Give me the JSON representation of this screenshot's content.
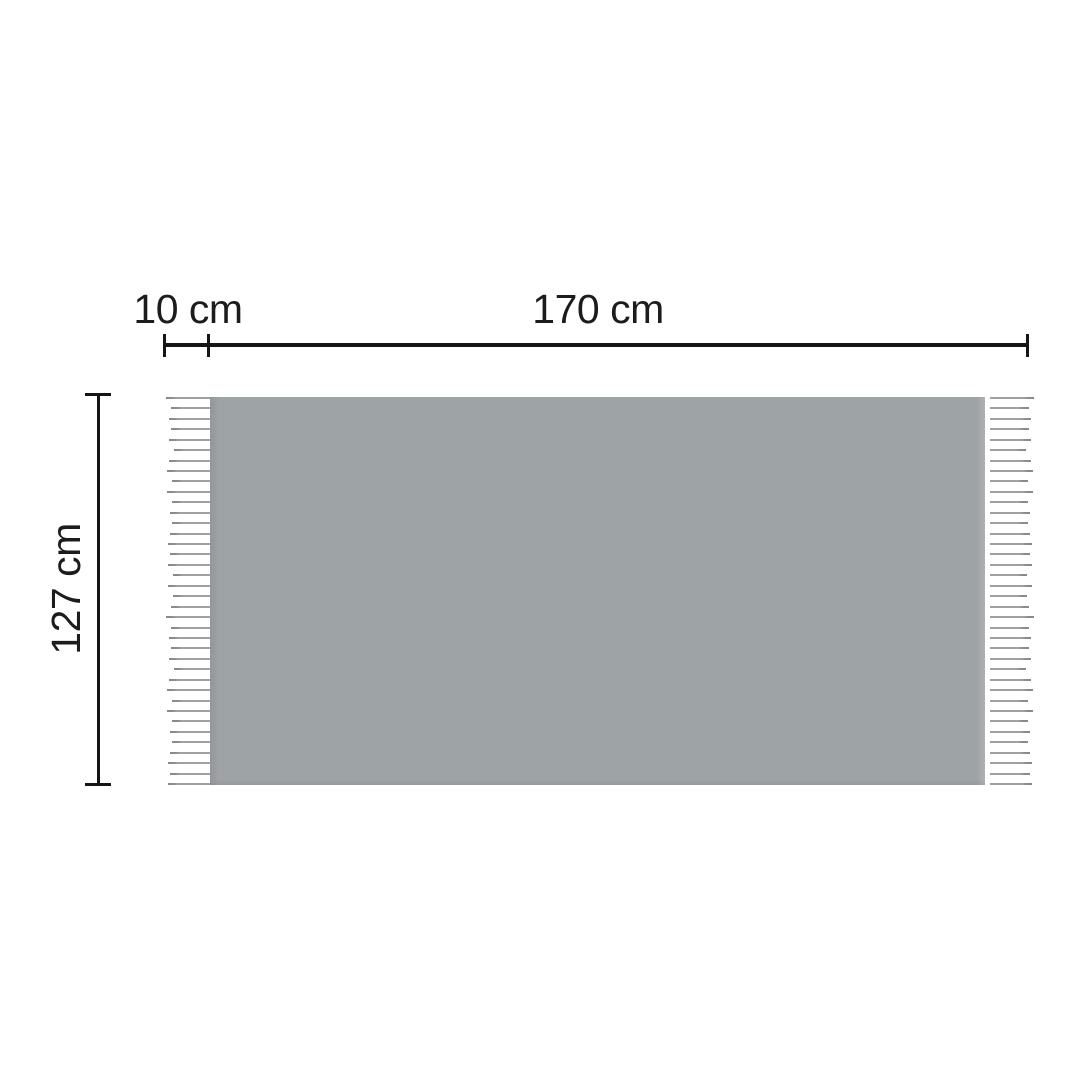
{
  "diagram": {
    "type": "product-dimension-diagram",
    "labels": {
      "fringe_width": "10 cm",
      "width": "170 cm",
      "height": "127 cm"
    },
    "colors": {
      "background": "#ffffff",
      "blanket": "#9ea3a5",
      "fringe_line": "#a0a0a0",
      "fringe_tip": "#8a8a8a",
      "dimension_line": "#151515",
      "label_text": "#1c1c1c"
    },
    "fringe": {
      "count": 38,
      "line_thickness": 2,
      "max_length": 44
    }
  }
}
